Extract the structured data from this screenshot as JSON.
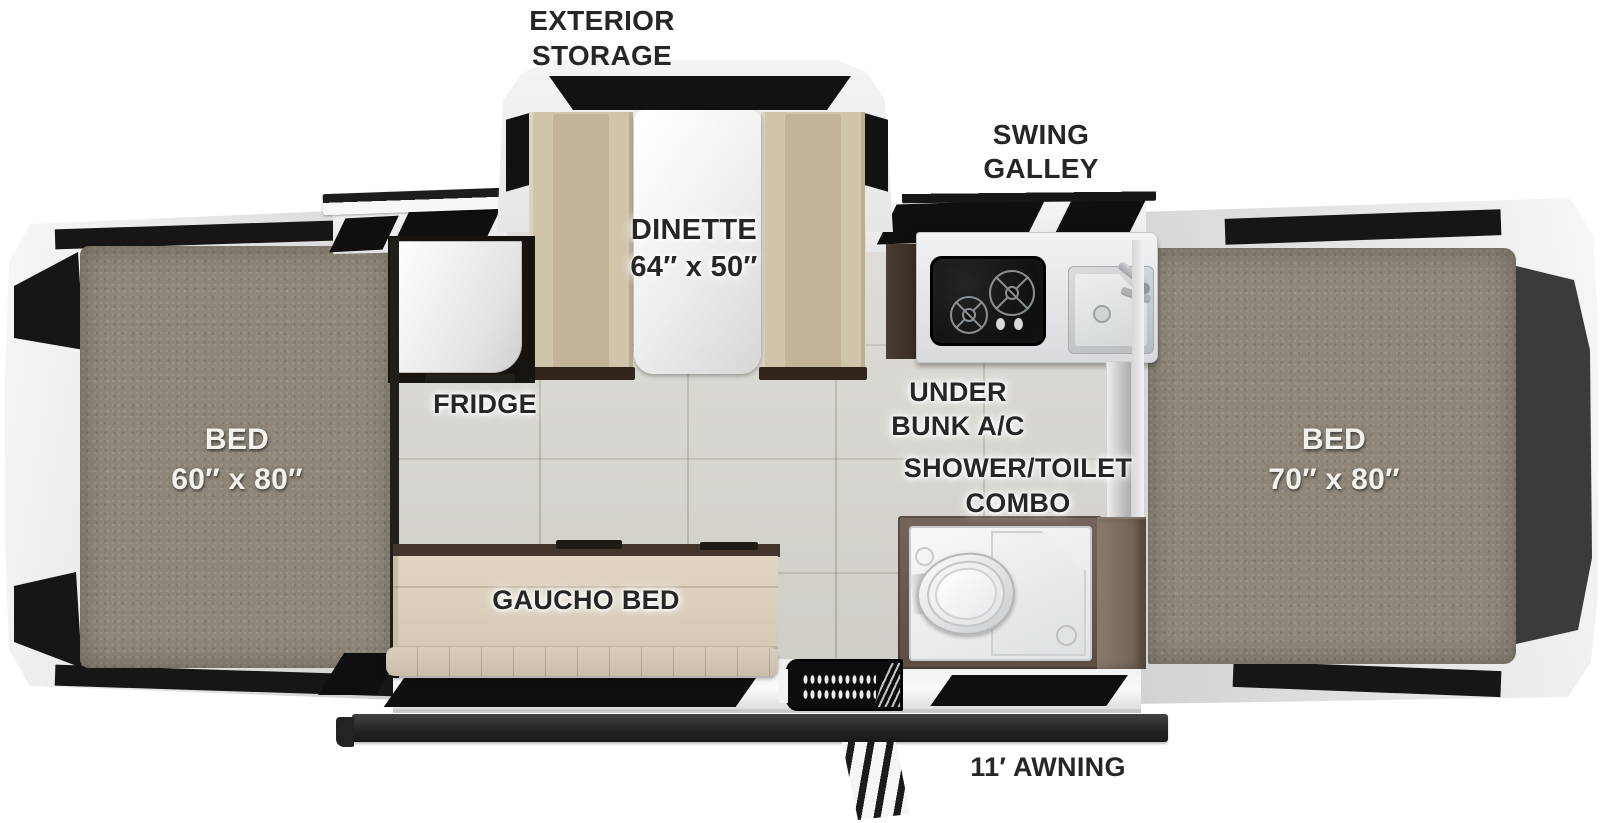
{
  "floorplan": {
    "title": "Pop-up camper floor plan",
    "labels": {
      "exterior_storage": {
        "line1": "EXTERIOR",
        "line2": "STORAGE"
      },
      "swing_galley": {
        "line1": "SWING",
        "line2": "GALLEY"
      },
      "dinette": {
        "line1": "DINETTE",
        "line2": "64″ x 50″"
      },
      "fridge": {
        "text": "FRIDGE"
      },
      "under_bunk_ac": {
        "line1": "UNDER",
        "line2": "BUNK A/C"
      },
      "shower_toilet": {
        "line1": "SHOWER/TOILET",
        "line2": "COMBO"
      },
      "bed_front": {
        "line1": "BED",
        "line2": "60″ x 80″"
      },
      "bed_rear": {
        "line1": "BED",
        "line2": "70″ x 80″"
      },
      "gaucho_bed": {
        "text": "GAUCHO BED"
      },
      "awning": {
        "text": "11′ AWNING"
      }
    },
    "colors": {
      "canvas_bg": "#ffffff",
      "mattress_carpet": "#8e8678",
      "floor_tile": "#d8d5cf",
      "bench_cushion": "#d0c4ab",
      "gaucho_beige": "#ddd3c0",
      "wood_brown": "#6e5d52",
      "shell_white": "#ececec",
      "accent_black": "#141414",
      "awning_dark": "#29292b"
    }
  }
}
